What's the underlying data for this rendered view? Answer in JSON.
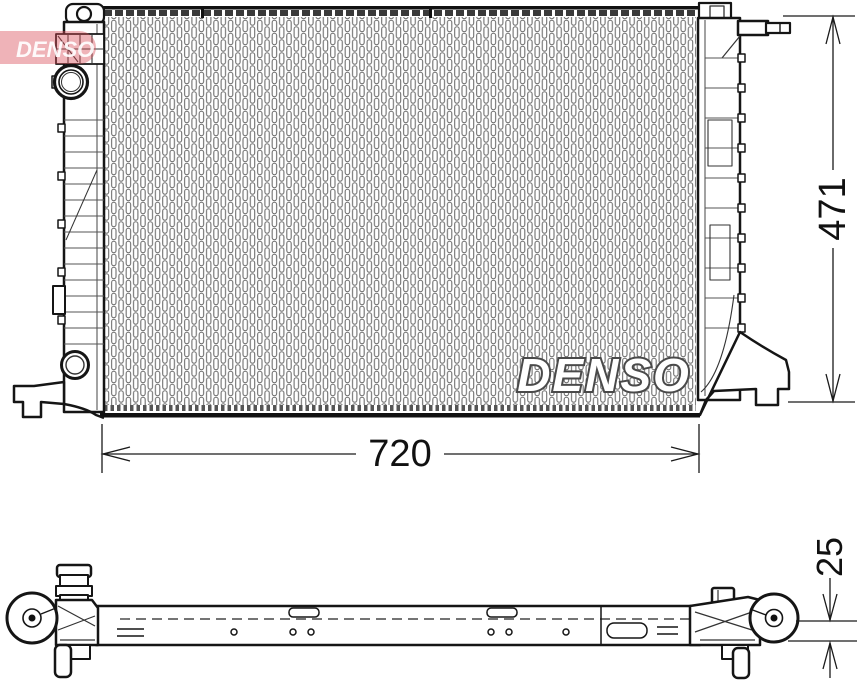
{
  "brand": {
    "logo_text": "DENSO",
    "logo_color": "#d84a55",
    "watermark_text": "DENSO"
  },
  "dimensions": {
    "overall_width": {
      "label": "720"
    },
    "overall_height": {
      "label": "471"
    },
    "core_thickness": {
      "label": "25"
    }
  },
  "drawing": {
    "line_color": "#151515",
    "fin_color": "#6f6f6f",
    "views": [
      {
        "name": "front-view"
      },
      {
        "name": "bottom-profile-view"
      }
    ]
  }
}
